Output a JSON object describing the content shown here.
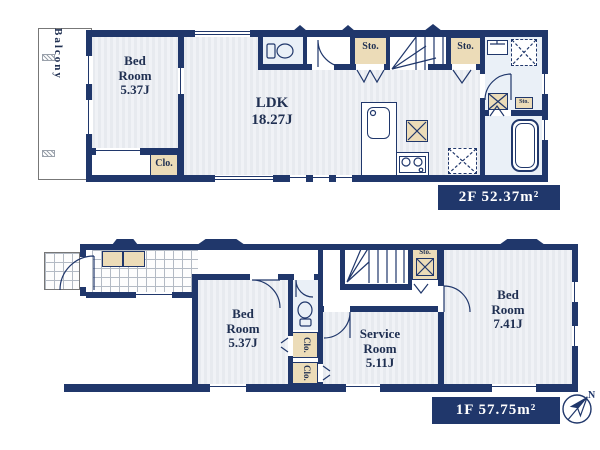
{
  "colors": {
    "wall_navy": "#20376b",
    "room_fill": "#e9ecf1",
    "storage_tan": "#ecdcb8",
    "label_text": "#203052",
    "area_box_bg": "#20376b",
    "area_box_text": "#ffffff"
  },
  "floor2": {
    "balcony": {
      "label": "Balcony"
    },
    "bedroom": {
      "name": "Bed Room",
      "size": "5.37J"
    },
    "closet": {
      "label": "Clo."
    },
    "ldk": {
      "name": "LDK",
      "size": "18.27J"
    },
    "storage_left": {
      "label": "Sto."
    },
    "storage_right": {
      "label": "Sto."
    },
    "linen": {
      "label": "Sto."
    },
    "area": {
      "label": "2F 52.37m²"
    }
  },
  "floor1": {
    "bedroom_small": {
      "name": "Bed Room",
      "size": "5.37J"
    },
    "closet_upper": {
      "label": "Clo."
    },
    "closet_lower": {
      "label": "Clo."
    },
    "service_room": {
      "name": "Service Room",
      "size": "5.11J"
    },
    "bedroom_large": {
      "name": "Bed Room",
      "size": "7.41J"
    },
    "storage": {
      "label": "Sto."
    },
    "area": {
      "label": "1F 57.75m²"
    }
  },
  "compass": {
    "label": "N"
  }
}
